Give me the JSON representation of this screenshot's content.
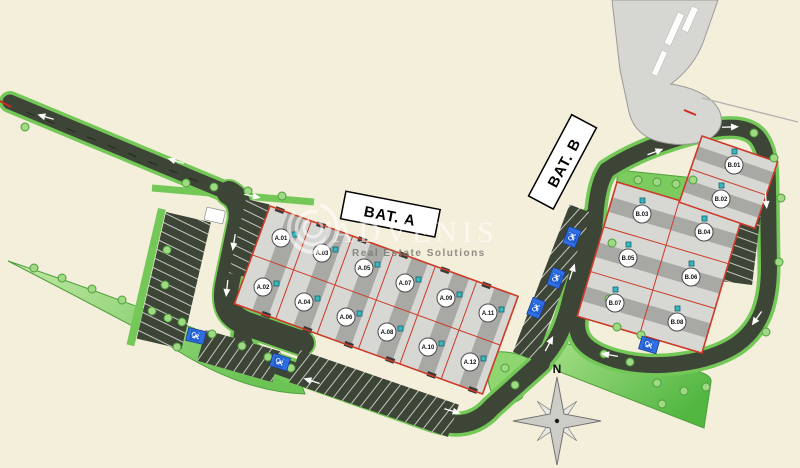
{
  "watermark": {
    "brand": "ADVENIS",
    "tagline": "Real Estate Solutions"
  },
  "compass": {
    "north_label": "N"
  },
  "buildings": [
    {
      "id": "bat_a",
      "label": "BAT. A",
      "units": [
        {
          "label": "A.01"
        },
        {
          "label": "A.02"
        },
        {
          "label": "A.03"
        },
        {
          "label": "A.04"
        },
        {
          "label": "A.05"
        },
        {
          "label": "A.06"
        },
        {
          "label": "A.07"
        },
        {
          "label": "A.08"
        },
        {
          "label": "A.09"
        },
        {
          "label": "A.10"
        },
        {
          "label": "A.11"
        },
        {
          "label": "A.12"
        }
      ]
    },
    {
      "id": "bat_b",
      "label": "BAT. B",
      "units": [
        {
          "label": "B.01"
        },
        {
          "label": "B.02"
        },
        {
          "label": "B.03"
        },
        {
          "label": "B.04"
        },
        {
          "label": "B.05"
        },
        {
          "label": "B.06"
        },
        {
          "label": "B.07"
        },
        {
          "label": "B.08"
        }
      ]
    }
  ],
  "colors": {
    "background": "#f4efdb",
    "road": "#3d4536",
    "green-edge": "#74c858",
    "building-fill": "#d7d7d4",
    "building-stripe": "#a8a8a5",
    "plot-line": "#cc3a28",
    "accessible-blue": "#2f6fe3",
    "marker-teal": "#35b8be",
    "existing-gray": "#d6d6d3"
  }
}
